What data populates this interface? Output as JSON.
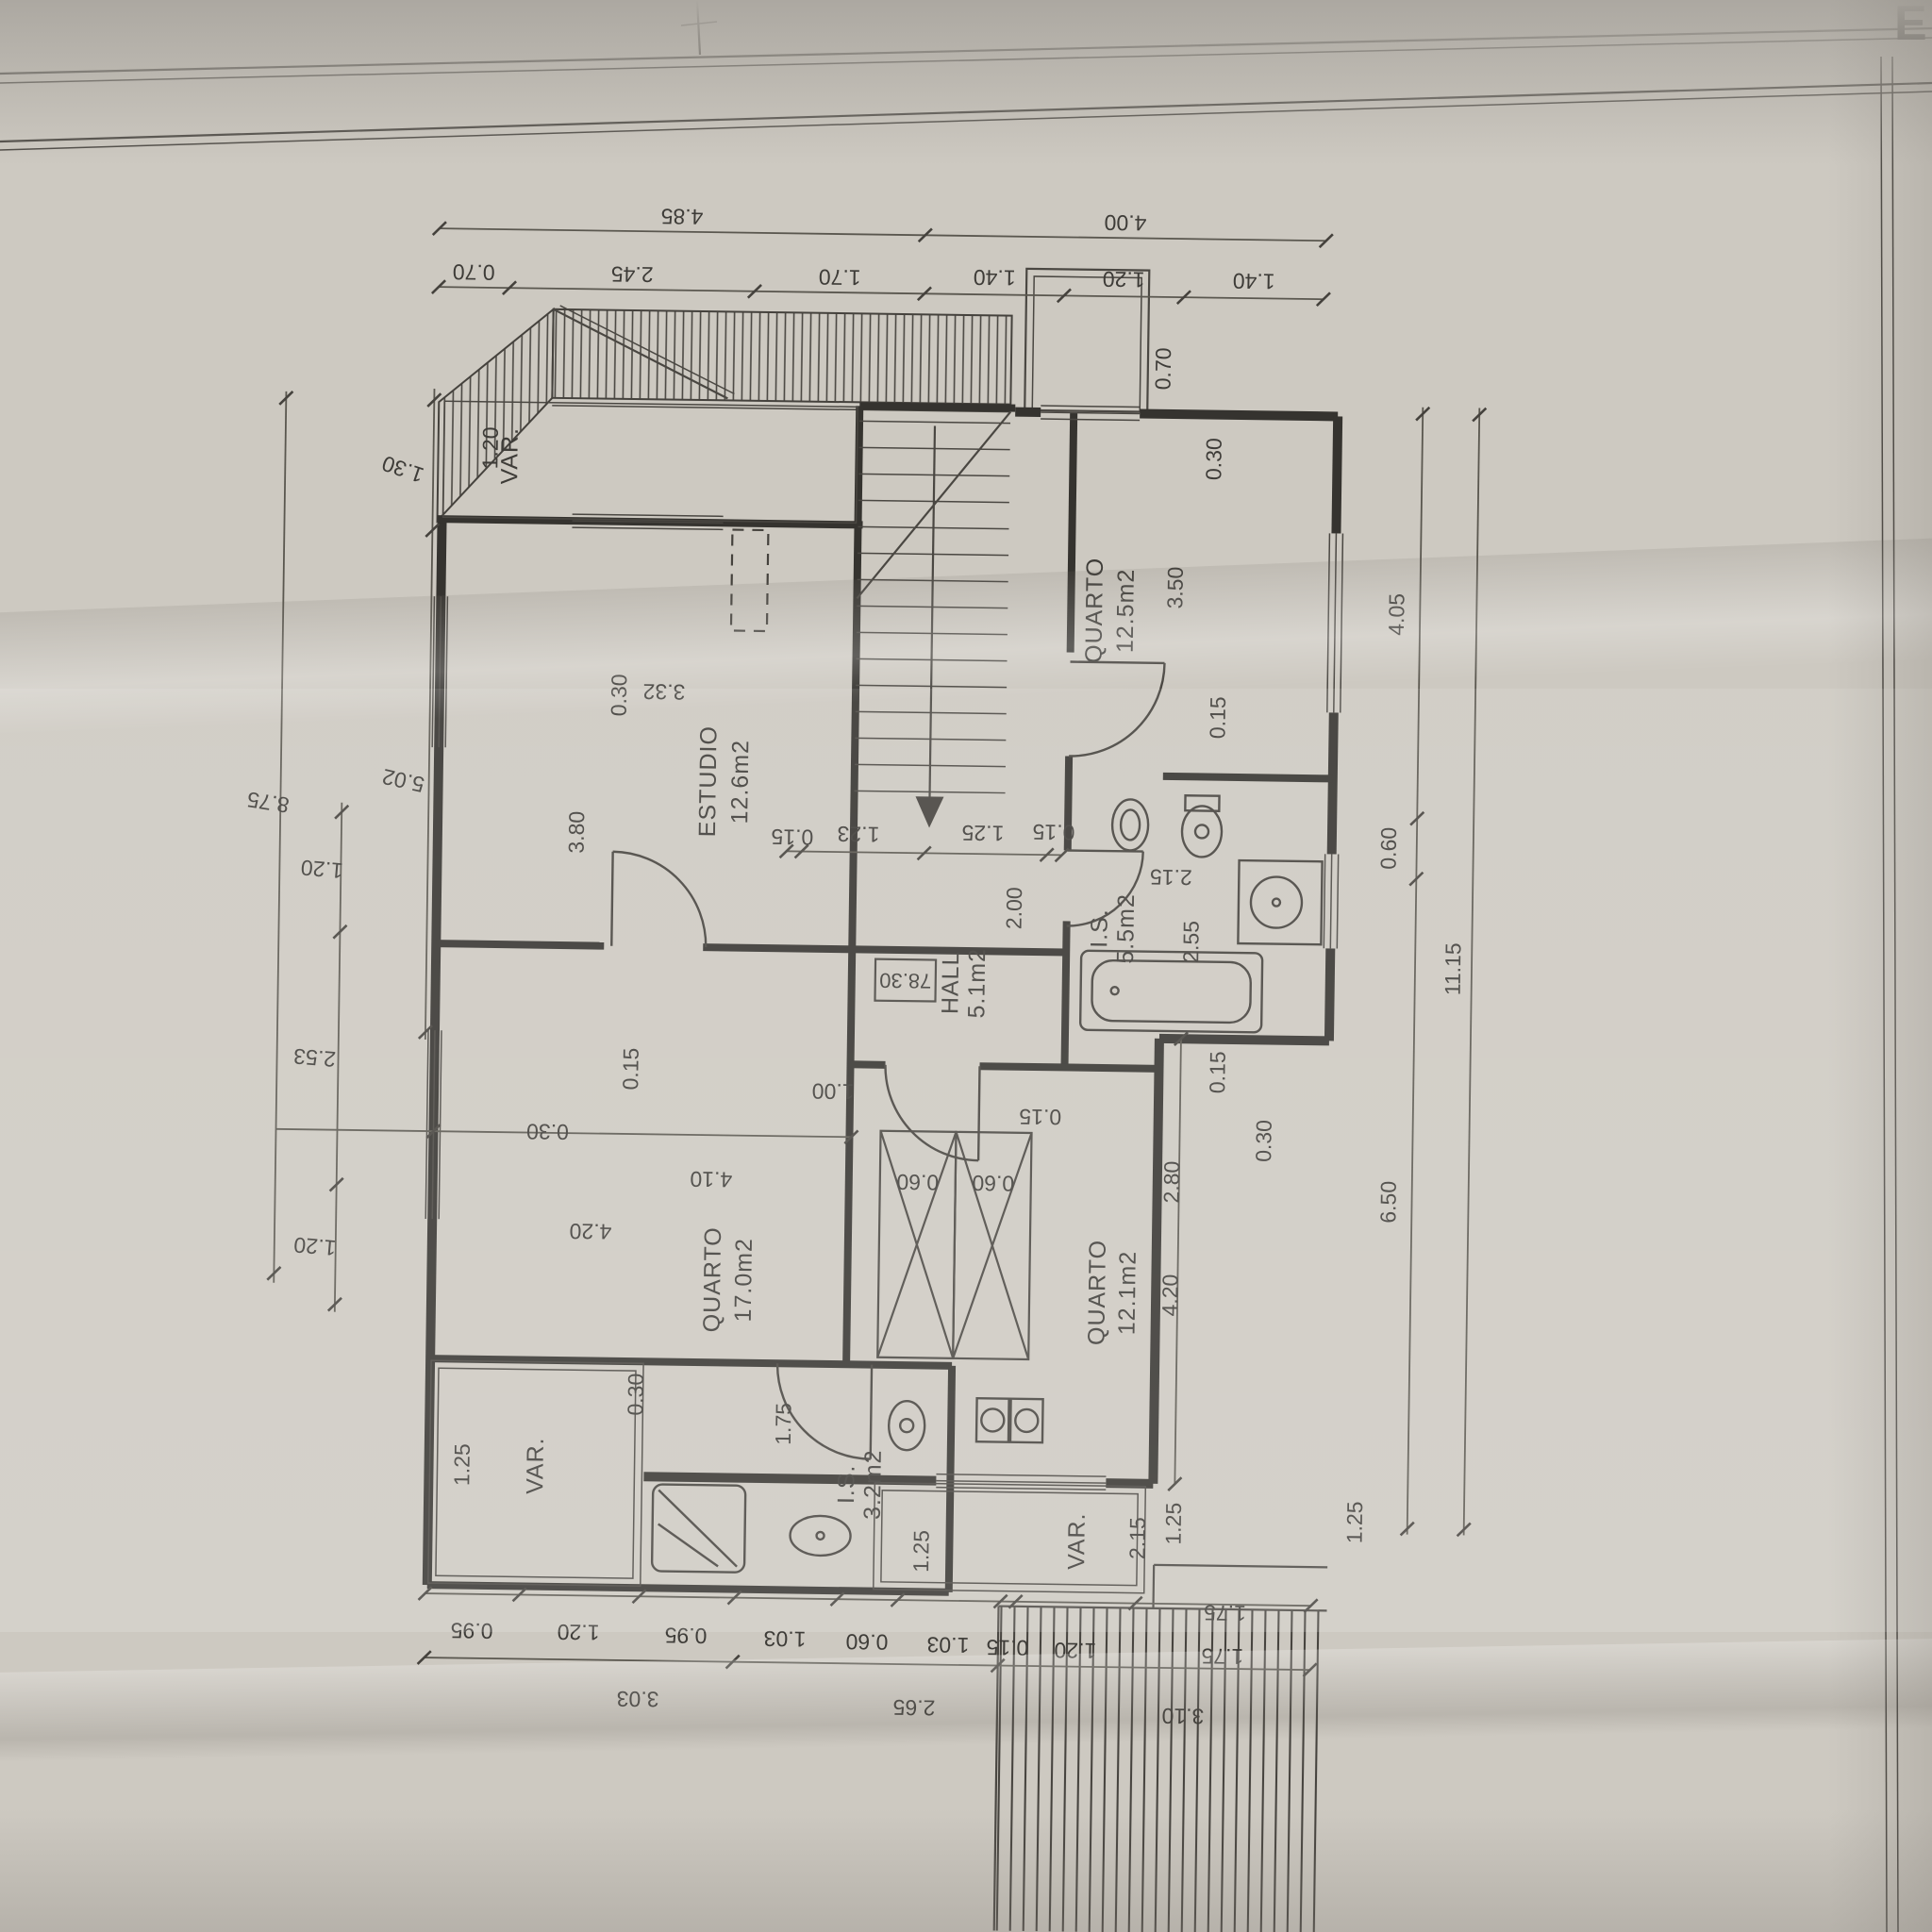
{
  "sheet": {
    "corner_mark": "E"
  },
  "rooms": {
    "quarto_ne": {
      "label": "QUARTO",
      "area": "12.5m2"
    },
    "estudio": {
      "label": "ESTUDIO",
      "area": "12.6m2"
    },
    "hall": {
      "label": "HALL",
      "area": "5.1m2",
      "level": "78.30"
    },
    "is_main": {
      "label": "I.S.",
      "area": "5.5m2"
    },
    "quarto_w": {
      "label": "QUARTO",
      "area": "17.0m2"
    },
    "quarto_s": {
      "label": "QUARTO",
      "area": "12.1m2"
    },
    "is_small": {
      "label": "I.S.",
      "area": "3.2m2"
    },
    "var_top": {
      "label": "VAR."
    },
    "var_left": {
      "label": "VAR."
    },
    "var_bottom": {
      "label": "VAR."
    }
  },
  "dims": {
    "top_outer": [
      "4.85",
      "4.00"
    ],
    "top_inner": [
      "0.70",
      "2.45",
      "1.70",
      "1.40",
      "1.20",
      "1.40"
    ],
    "left_inner": [
      "1.30",
      "5.02"
    ],
    "left_mid": [
      "1.20",
      "2.53",
      "1.20"
    ],
    "left_outer": [
      "8.75"
    ],
    "right_inner": [
      "4.05",
      "0.60",
      "6.50"
    ],
    "right_extra": [
      "1.25"
    ],
    "right_outer": [
      "11.15"
    ],
    "bottom_inner": [
      "0.95",
      "1.20",
      "0.95",
      "1.03",
      "0.60",
      "1.03",
      "0.15",
      "1.20",
      "1.75"
    ],
    "bottom_outer": [
      "3.03",
      "2.65",
      "3.10"
    ],
    "interior": [
      "1.20",
      "0.30",
      "3.80",
      "3.32",
      "0.15",
      "1.23",
      "1.25",
      "0.15",
      "2.00",
      "0.70",
      "0.30",
      "3.50",
      "0.15",
      "2.15",
      "2.55",
      "0.15",
      "0.30",
      "2.80",
      "4.20",
      "0.15",
      "0.30",
      "4.10",
      "4.20",
      "1.00",
      "0.60",
      "0.60",
      "0.15",
      "1.75",
      "1.25",
      "0.30",
      "2.15",
      "1.25",
      "1.75",
      "1.25"
    ]
  }
}
